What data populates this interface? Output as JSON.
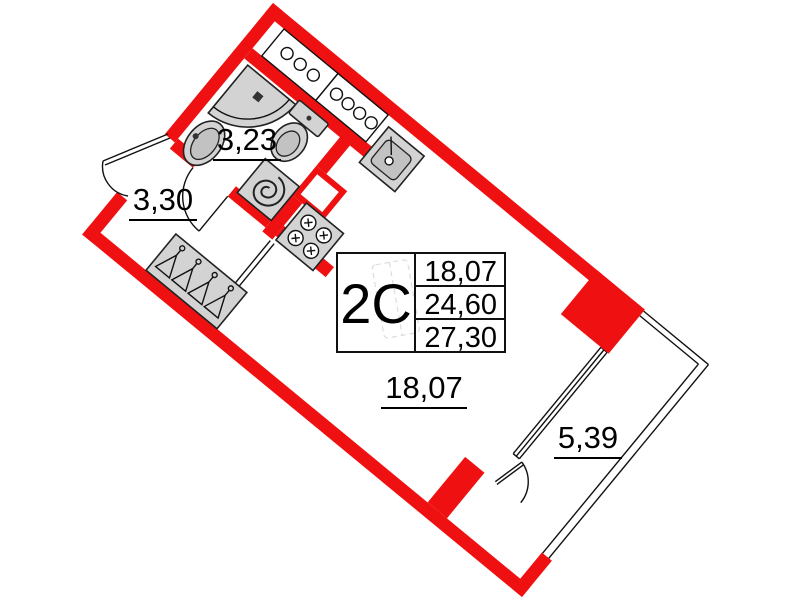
{
  "plan": {
    "unit": {
      "type_code": "2С",
      "living_area": "18,07",
      "area_without_balcony": "24,60",
      "total_area": "27,30"
    },
    "rooms": [
      {
        "name": "bathroom",
        "area": "3,23"
      },
      {
        "name": "hallway",
        "area": "3,30"
      },
      {
        "name": "living-room",
        "area": "18,07"
      },
      {
        "name": "balcony",
        "area": "5,39"
      }
    ],
    "colors": {
      "wall_red": "#ef1111",
      "fixture_gray": "#d3d3d3",
      "line_black": "#111111"
    },
    "icons": [
      "shower-icon",
      "washbasin-icon",
      "toilet-icon",
      "kitchen-sink-icon",
      "stove-spiral-icon",
      "cooktop-icon",
      "wardrobe-hangers-icon",
      "utility-shaft-icon",
      "door-swing-arc"
    ]
  }
}
